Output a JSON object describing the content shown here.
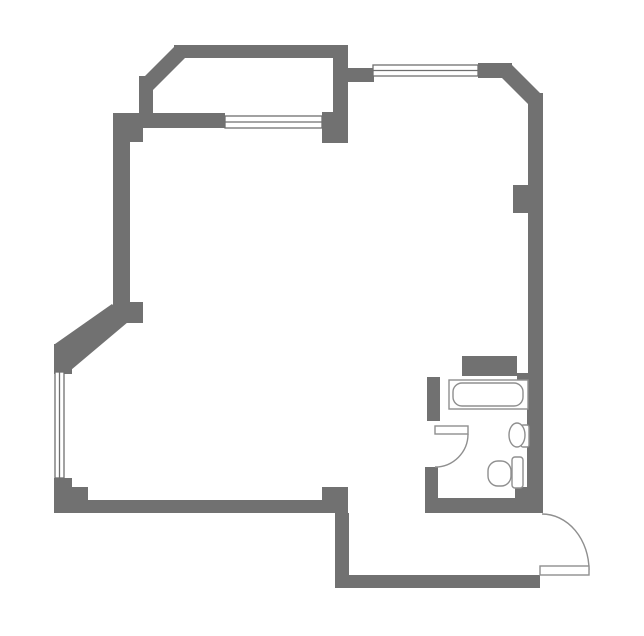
{
  "canvas": {
    "width": 644,
    "height": 636,
    "background": "#ffffff"
  },
  "colors": {
    "wall": "#717171",
    "window_stroke": "#6f6f6f",
    "door_stroke": "#8f8f8f",
    "fixture_stroke": "#8f8f8f"
  },
  "floorplan": {
    "walls": [
      {
        "name": "bay-top-wall",
        "shape": "rect",
        "x": 174,
        "y": 45,
        "w": 174,
        "h": 13
      },
      {
        "name": "bay-diagonal-wall",
        "shape": "polygon",
        "points": "176,45 141,80 152,91 187,56"
      },
      {
        "name": "bay-left-wall",
        "shape": "rect",
        "x": 139,
        "y": 76,
        "w": 14,
        "h": 42
      },
      {
        "name": "bay-inner-wall",
        "shape": "rect",
        "x": 140,
        "y": 113,
        "w": 85,
        "h": 15
      },
      {
        "name": "bay-right-wall",
        "shape": "rect",
        "x": 333,
        "y": 58,
        "w": 15,
        "h": 85
      },
      {
        "name": "bay-right-pier",
        "shape": "rect",
        "x": 322,
        "y": 112,
        "w": 26,
        "h": 31
      },
      {
        "name": "top-connector-wall",
        "shape": "rect",
        "x": 348,
        "y": 68,
        "w": 26,
        "h": 14
      },
      {
        "name": "top-right-wall",
        "shape": "rect",
        "x": 478,
        "y": 63,
        "w": 34,
        "h": 15
      },
      {
        "name": "top-right-diagonal-wall",
        "shape": "polygon",
        "points": "510,63 543,96 532,108 499,75"
      },
      {
        "name": "right-wall-upper",
        "shape": "rect",
        "x": 528,
        "y": 93,
        "w": 15,
        "h": 122
      },
      {
        "name": "right-wall-pier",
        "shape": "rect",
        "x": 513,
        "y": 185,
        "w": 15,
        "h": 28
      },
      {
        "name": "right-wall-mid",
        "shape": "rect",
        "x": 528,
        "y": 213,
        "w": 15,
        "h": 162
      },
      {
        "name": "right-wall-step",
        "shape": "rect",
        "x": 517,
        "y": 373,
        "w": 26,
        "h": 10
      },
      {
        "name": "right-wall-lower",
        "shape": "rect",
        "x": 527,
        "y": 383,
        "w": 16,
        "h": 130
      },
      {
        "name": "bathroom-top-wall",
        "shape": "rect",
        "x": 462,
        "y": 356,
        "w": 55,
        "h": 20
      },
      {
        "name": "bathroom-left-wall-upper",
        "shape": "rect",
        "x": 427,
        "y": 377,
        "w": 13,
        "h": 44
      },
      {
        "name": "bathroom-left-wall-lower",
        "shape": "rect",
        "x": 425,
        "y": 467,
        "w": 13,
        "h": 46
      },
      {
        "name": "bathroom-bottom-wall",
        "shape": "rect",
        "x": 425,
        "y": 498,
        "w": 118,
        "h": 15
      },
      {
        "name": "bathroom-corner-block",
        "shape": "rect",
        "x": 515,
        "y": 487,
        "w": 28,
        "h": 16
      },
      {
        "name": "bottom-wall-right",
        "shape": "rect",
        "x": 335,
        "y": 575,
        "w": 205,
        "h": 13
      },
      {
        "name": "bottom-offset-wall",
        "shape": "rect",
        "x": 335,
        "y": 513,
        "w": 14,
        "h": 70
      },
      {
        "name": "bottom-offset-corner",
        "shape": "rect",
        "x": 322,
        "y": 487,
        "w": 26,
        "h": 26
      },
      {
        "name": "bottom-wall-left",
        "shape": "rect",
        "x": 54,
        "y": 500,
        "w": 268,
        "h": 13
      },
      {
        "name": "bottom-left-pier",
        "shape": "rect",
        "x": 54,
        "y": 478,
        "w": 18,
        "h": 35
      },
      {
        "name": "bottom-left-step",
        "shape": "rect",
        "x": 72,
        "y": 487,
        "w": 16,
        "h": 26
      },
      {
        "name": "left-wall-top-corner",
        "shape": "rect",
        "x": 113,
        "y": 113,
        "w": 30,
        "h": 29
      },
      {
        "name": "left-wall",
        "shape": "rect",
        "x": 113,
        "y": 128,
        "w": 17,
        "h": 180
      },
      {
        "name": "left-wall-bottom-corner",
        "shape": "rect",
        "x": 113,
        "y": 302,
        "w": 30,
        "h": 21
      },
      {
        "name": "left-diagonal-wall",
        "shape": "polygon",
        "points": "112,304 55,344 71,370 128,322"
      },
      {
        "name": "left-window-pier",
        "shape": "rect",
        "x": 54,
        "y": 344,
        "w": 18,
        "h": 30
      }
    ],
    "windows": [
      {
        "name": "bay-window",
        "shape": "rect",
        "x": 225,
        "y": 116,
        "w": 97,
        "h": 12
      },
      {
        "name": "bay-window-mullion",
        "shape": "line",
        "x1": 225,
        "y1": 122,
        "x2": 322,
        "y2": 122
      },
      {
        "name": "top-window",
        "shape": "rect",
        "x": 373,
        "y": 65,
        "w": 105,
        "h": 11
      },
      {
        "name": "top-window-mullion",
        "shape": "line",
        "x1": 373,
        "y1": 70.5,
        "x2": 478,
        "y2": 70.5
      },
      {
        "name": "left-window",
        "shape": "rect",
        "x": 55,
        "y": 372,
        "w": 9,
        "h": 106
      },
      {
        "name": "left-window-mullion",
        "shape": "line",
        "x1": 59.5,
        "y1": 372,
        "x2": 59.5,
        "y2": 478
      }
    ],
    "doors": [
      {
        "name": "bathroom-door-swing-arc",
        "shape": "path",
        "kind": "arc",
        "d": "M 468,434 A 33 33 0 0 1 435,467"
      },
      {
        "name": "bathroom-door-leaf",
        "shape": "rect",
        "kind": "leaf",
        "x": 435,
        "y": 426,
        "w": 33,
        "h": 8
      },
      {
        "name": "entry-door-swing-arc",
        "shape": "path",
        "kind": "arc",
        "d": "M 542,514 A 47 56 0 0 1 589,570"
      },
      {
        "name": "entry-door-leaf",
        "shape": "rect",
        "kind": "leaf",
        "x": 540,
        "y": 566,
        "w": 49,
        "h": 9
      }
    ],
    "fixtures": [
      {
        "name": "bathtub-rim",
        "shape": "rect",
        "x": 449,
        "y": 380,
        "w": 79,
        "h": 29
      },
      {
        "name": "bathtub-basin",
        "shape": "rect",
        "x": 453,
        "y": 383,
        "w": 70,
        "h": 23,
        "rx": 9
      },
      {
        "name": "sink-pedestal",
        "shape": "rect",
        "x": 521,
        "y": 425,
        "w": 8,
        "h": 22,
        "rx": 2
      },
      {
        "name": "sink-bowl",
        "shape": "ellipse",
        "cx": 517,
        "cy": 435,
        "rx": 8,
        "ry": 12
      },
      {
        "name": "toilet-tank",
        "shape": "rect",
        "x": 512,
        "y": 457,
        "w": 11,
        "h": 31,
        "rx": 3
      },
      {
        "name": "toilet-bowl",
        "shape": "rect",
        "x": 488,
        "y": 461,
        "w": 23,
        "h": 25,
        "rx": 10
      }
    ]
  }
}
